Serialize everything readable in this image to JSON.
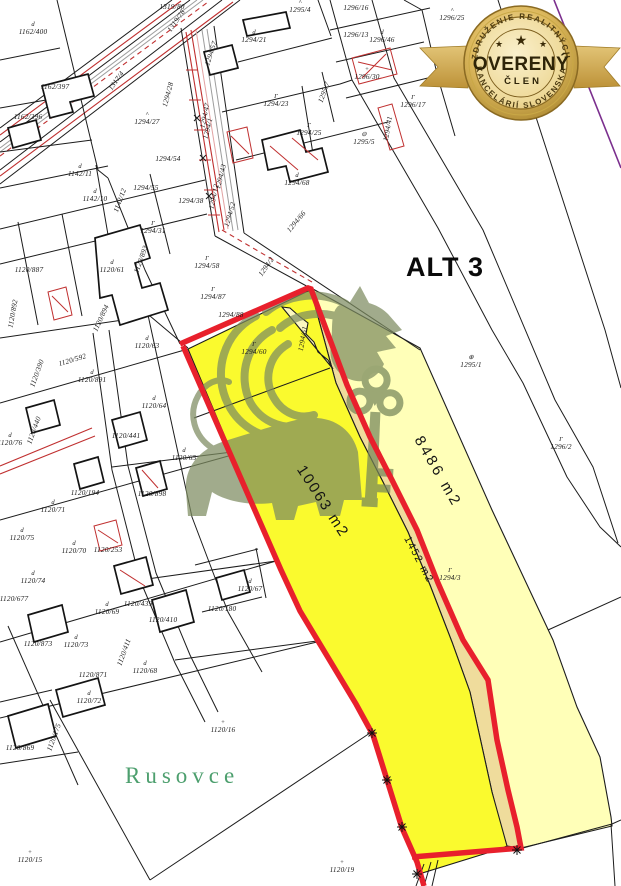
{
  "badge": {
    "arc_top": "ZDRUŽENIE REALITNÝCH",
    "title": "OVERENÝ",
    "subtitle": "ČLEN",
    "arc_bottom": "KANCELÁRIÍ SLOVENSKA",
    "star": "★"
  },
  "map": {
    "alt_label": "ALT 3",
    "place_label": "Rusovce",
    "colors": {
      "highlight_bright": "#fafa2e",
      "highlight_pale": "#ffffb8",
      "highlight_strip": "#efdc9c",
      "border_red": "#e8202c",
      "map_line": "#1c1c1c",
      "utility_red": "#c03030",
      "place_green": "#4d9f6e",
      "boundary_purple": "#7b2f8e",
      "badge_gold": "#c9a23c"
    },
    "areas": [
      {
        "text": "8486 m2",
        "x": 434,
        "y": 474,
        "rotate": 60,
        "size": 15,
        "spacing": 3
      },
      {
        "text": "10063 m2",
        "x": 319,
        "y": 504,
        "rotate": 57,
        "size": 15,
        "spacing": 2
      },
      {
        "text": "1452 m2",
        "x": 416,
        "y": 561,
        "rotate": 62,
        "size": 10.5,
        "spacing": 1.5
      }
    ],
    "stars": [
      [
        372,
        733
      ],
      [
        387,
        780
      ],
      [
        402,
        827
      ],
      [
        417,
        874
      ],
      [
        517,
        850
      ]
    ],
    "parcel_labels": [
      {
        "t": "1162/400",
        "x": 33,
        "y": 34,
        "sym": "d"
      },
      {
        "t": "1162/397",
        "x": 55,
        "y": 89
      },
      {
        "t": "1162/396",
        "x": 28,
        "y": 119
      },
      {
        "t": "1317/4",
        "x": 118,
        "y": 82,
        "r": -55
      },
      {
        "t": "1319/80",
        "x": 172,
        "y": 9
      },
      {
        "t": "1319/78",
        "x": 178,
        "y": 22,
        "r": -55
      },
      {
        "t": "1294/28",
        "x": 170,
        "y": 95,
        "r": -75
      },
      {
        "t": "1294/27",
        "x": 147,
        "y": 124,
        "sym": "^"
      },
      {
        "t": "1294/57",
        "x": 213,
        "y": 54,
        "r": -72
      },
      {
        "t": "1294/21",
        "x": 254,
        "y": 42,
        "sym": "d"
      },
      {
        "t": "1295/4",
        "x": 300,
        "y": 12,
        "sym": "^"
      },
      {
        "t": "1296/16",
        "x": 356,
        "y": 10
      },
      {
        "t": "1296/25",
        "x": 452,
        "y": 20,
        "sym": "^"
      },
      {
        "t": "1296/13",
        "x": 356,
        "y": 37
      },
      {
        "t": "1296/46",
        "x": 382,
        "y": 42,
        "sym": "d"
      },
      {
        "t": "1296/30",
        "x": 367,
        "y": 79,
        "sym": "+"
      },
      {
        "t": "1296/17",
        "x": 413,
        "y": 107,
        "sym": "Γ"
      },
      {
        "t": "1295/7",
        "x": 326,
        "y": 93,
        "r": -70
      },
      {
        "t": "1294/23",
        "x": 276,
        "y": 106,
        "sym": "Γ"
      },
      {
        "t": "1294/25",
        "x": 309,
        "y": 135,
        "sym": "Γ"
      },
      {
        "t": "1295/5",
        "x": 364,
        "y": 144,
        "sym": "⊖"
      },
      {
        "t": "1294/41",
        "x": 390,
        "y": 129,
        "r": -80
      },
      {
        "t": "1142/11",
        "x": 80,
        "y": 176,
        "sym": "d"
      },
      {
        "t": "1142/10",
        "x": 95,
        "y": 201,
        "sym": "d"
      },
      {
        "t": "1142/12",
        "x": 122,
        "y": 201,
        "r": -70
      },
      {
        "t": "1294/55",
        "x": 146,
        "y": 190
      },
      {
        "t": "1294/54",
        "x": 168,
        "y": 161
      },
      {
        "t": "1294/31",
        "x": 153,
        "y": 233,
        "sym": "Γ"
      },
      {
        "t": "1294/38",
        "x": 191,
        "y": 203
      },
      {
        "t": "1294/68",
        "x": 297,
        "y": 185,
        "sym": "d"
      },
      {
        "t": "1294/47",
        "x": 207,
        "y": 116,
        "r": -78
      },
      {
        "t": "1294/1",
        "x": 210,
        "y": 129,
        "r": -76
      },
      {
        "t": "1294/12",
        "x": 216,
        "y": 197,
        "r": -78
      },
      {
        "t": "1294/43",
        "x": 223,
        "y": 177,
        "r": -76
      },
      {
        "t": "1294/52",
        "x": 232,
        "y": 215,
        "r": -74
      },
      {
        "t": "1294/66",
        "x": 298,
        "y": 223,
        "r": -50
      },
      {
        "t": "1294/2",
        "x": 268,
        "y": 268,
        "r": -55
      },
      {
        "t": "1294/58",
        "x": 207,
        "y": 268,
        "sym": "Γ"
      },
      {
        "t": "1294/87",
        "x": 213,
        "y": 299,
        "sym": "Γ"
      },
      {
        "t": "1294/88",
        "x": 231,
        "y": 317
      },
      {
        "t": "1294/60",
        "x": 254,
        "y": 354,
        "sym": "Γ"
      },
      {
        "t": "1294/61",
        "x": 305,
        "y": 339,
        "r": -80
      },
      {
        "t": "1120/887",
        "x": 29,
        "y": 272
      },
      {
        "t": "1120/61",
        "x": 112,
        "y": 272,
        "sym": "d"
      },
      {
        "t": "1120/893",
        "x": 143,
        "y": 260,
        "r": -70
      },
      {
        "t": "1120/894",
        "x": 103,
        "y": 319,
        "r": -65
      },
      {
        "t": "1120/892",
        "x": 15,
        "y": 314,
        "r": -80
      },
      {
        "t": "1120/63",
        "x": 147,
        "y": 348,
        "sym": "d"
      },
      {
        "t": "1120/592",
        "x": 73,
        "y": 362,
        "r": -17
      },
      {
        "t": "1120/891",
        "x": 92,
        "y": 382,
        "sym": "d"
      },
      {
        "t": "1120/390",
        "x": 39,
        "y": 374,
        "r": -70
      },
      {
        "t": "1120/64",
        "x": 154,
        "y": 408,
        "sym": "d"
      },
      {
        "t": "1120/441",
        "x": 126,
        "y": 438
      },
      {
        "t": "1120/440",
        "x": 36,
        "y": 431,
        "r": -70
      },
      {
        "t": "1120/76",
        "x": 10,
        "y": 445,
        "sym": "d"
      },
      {
        "t": "1120/65",
        "x": 184,
        "y": 460,
        "sym": "d"
      },
      {
        "t": "1120/194",
        "x": 85,
        "y": 495
      },
      {
        "t": "1120/898",
        "x": 152,
        "y": 496
      },
      {
        "t": "1120/71",
        "x": 53,
        "y": 512,
        "sym": "d"
      },
      {
        "t": "1120/75",
        "x": 22,
        "y": 540,
        "sym": "d"
      },
      {
        "t": "1120/70",
        "x": 74,
        "y": 553,
        "sym": "d"
      },
      {
        "t": "1120/253",
        "x": 108,
        "y": 552
      },
      {
        "t": "1120/74",
        "x": 33,
        "y": 583,
        "sym": "d"
      },
      {
        "t": "1120/677",
        "x": 14,
        "y": 601
      },
      {
        "t": "1120/439",
        "x": 138,
        "y": 606
      },
      {
        "t": "1120/69",
        "x": 107,
        "y": 614,
        "sym": "d"
      },
      {
        "t": "1120/410",
        "x": 163,
        "y": 622
      },
      {
        "t": "1120/411",
        "x": 126,
        "y": 653,
        "r": -70
      },
      {
        "t": "1120/68",
        "x": 145,
        "y": 673,
        "sym": "d"
      },
      {
        "t": "1120/873",
        "x": 38,
        "y": 646
      },
      {
        "t": "1120/73",
        "x": 76,
        "y": 647,
        "sym": "d"
      },
      {
        "t": "1120/871",
        "x": 93,
        "y": 677
      },
      {
        "t": "1120/72",
        "x": 89,
        "y": 703,
        "sym": "d"
      },
      {
        "t": "1120/869",
        "x": 20,
        "y": 750
      },
      {
        "t": "1120/175",
        "x": 56,
        "y": 738,
        "r": -70
      },
      {
        "t": "1120/67",
        "x": 250,
        "y": 591,
        "sym": "d"
      },
      {
        "t": "1120/180",
        "x": 222,
        "y": 611
      },
      {
        "t": "1120/16",
        "x": 223,
        "y": 732,
        "sym": "+"
      },
      {
        "t": "1120/19",
        "x": 342,
        "y": 872,
        "sym": "+"
      },
      {
        "t": "1120/15",
        "x": 30,
        "y": 862,
        "sym": "+"
      },
      {
        "t": "1295/1",
        "x": 471,
        "y": 367,
        "sym": "⊕"
      },
      {
        "t": "1296/2",
        "x": 561,
        "y": 449,
        "sym": "Γ"
      },
      {
        "t": "1294/3",
        "x": 450,
        "y": 580,
        "sym": "Γ"
      }
    ]
  }
}
